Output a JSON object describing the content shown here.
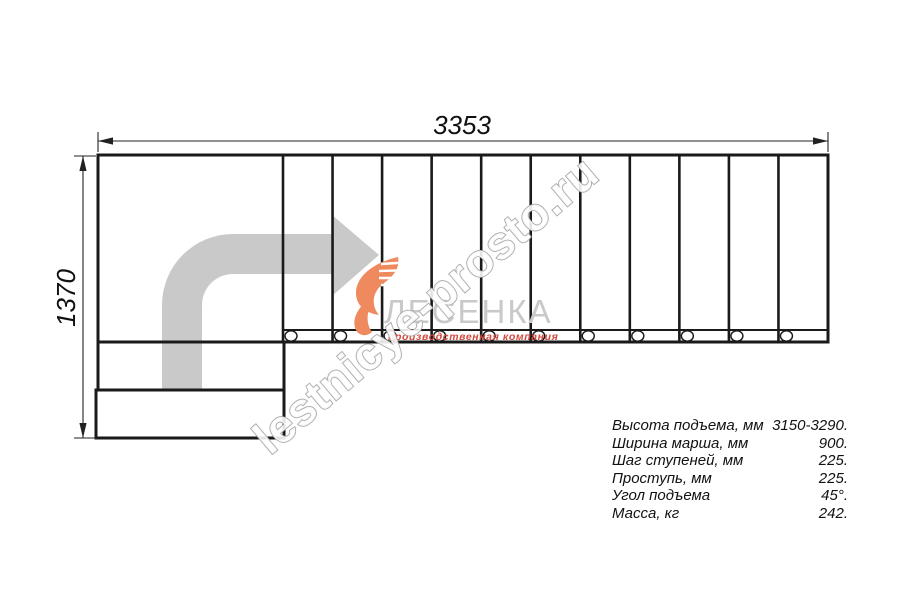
{
  "drawing": {
    "title": "stair-plan-top-view",
    "dimensions": {
      "total_length": "3353",
      "total_width": "1370"
    },
    "stairs": {
      "flight_treads": 11,
      "balusters": 11,
      "lower_steps": 2,
      "landing": 1
    },
    "direction_arrow": {
      "type": "turn-right-up-arrow",
      "color": "#c9c9c9"
    }
  },
  "watermark": {
    "text": "lestnicye-prosto.ru",
    "outline_color": "#a9a9a9"
  },
  "logo": {
    "name": "ЛЕСЕНКА",
    "subtitle": "производственная компания",
    "name_color": "#c9c9c9",
    "subtitle_color": "#d2493e",
    "swoosh_color": "#ef8a5f"
  },
  "specs": {
    "rows": [
      {
        "label": "Высота подъема, мм",
        "value": "3150-3290."
      },
      {
        "label": "Ширина марша, мм",
        "value": "900."
      },
      {
        "label": "Шаг ступеней, мм",
        "value": "225."
      },
      {
        "label": "Проступь, мм",
        "value": "225."
      },
      {
        "label": "Угол подъема",
        "value": "45°."
      },
      {
        "label": "Масса, кг",
        "value": "242."
      }
    ]
  },
  "colors": {
    "line": "#1a1a1a",
    "arrow_fill": "#c9c9c9",
    "background": "#ffffff"
  }
}
